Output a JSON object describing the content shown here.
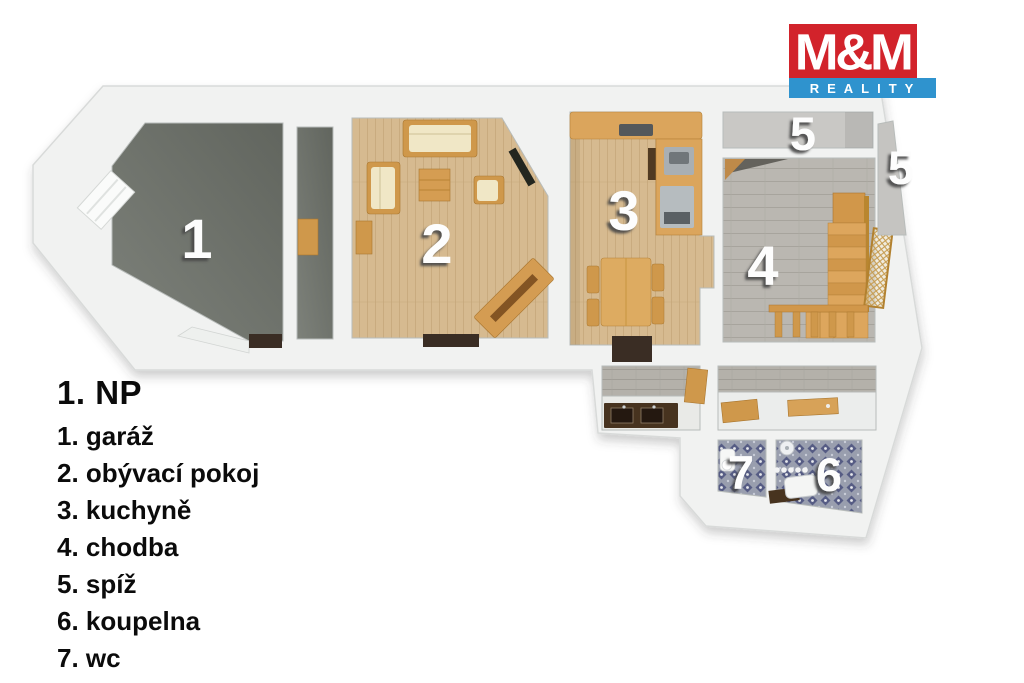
{
  "brand": {
    "mm": "M&M",
    "reality": "REALITY",
    "red": "#d2232b",
    "blue": "#2f93ce"
  },
  "legend": {
    "title": "1. NP",
    "items": [
      "1. garáž",
      "2. obývací pokoj",
      "3. kuchyně",
      "4. chodba",
      "5. spíž",
      "6. koupelna",
      "7. wc"
    ]
  },
  "plan": {
    "labels": [
      {
        "room": "garáž",
        "number": "1"
      },
      {
        "room": "obývací pokoj",
        "number": "2"
      },
      {
        "room": "kuchyně",
        "number": "3"
      },
      {
        "room": "chodba",
        "number": "4"
      },
      {
        "room": "spíž",
        "number": "5"
      },
      {
        "room": "spíž",
        "number": "5"
      },
      {
        "room": "koupelna",
        "number": "6"
      },
      {
        "room": "wc",
        "number": "7"
      }
    ],
    "colors": {
      "wall": "#f1f2f1",
      "garage_floor": "#6e726c",
      "wood_floor": "#d6ba90",
      "hall_tiles": "#bab7b1",
      "mosaic": "#999eae",
      "furniture_wood": "#cf984b",
      "cushion": "#f0e7c6",
      "threshold": "#3a2d24",
      "number_fill": "#fdfdfd"
    }
  }
}
